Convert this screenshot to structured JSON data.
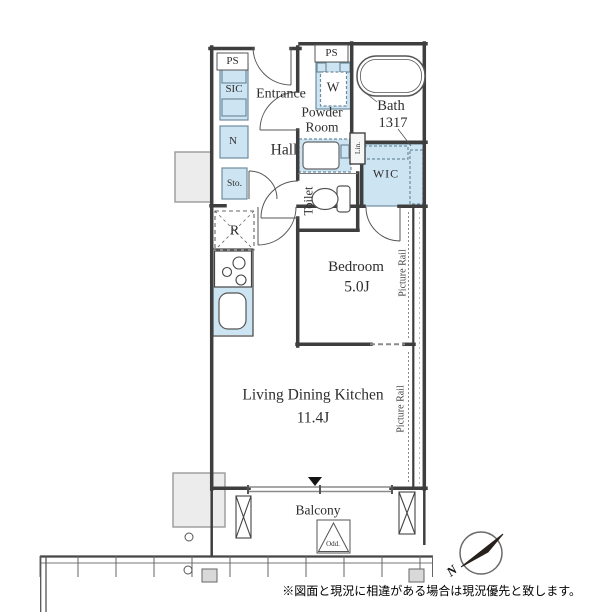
{
  "labels": {
    "ps_left": "PS",
    "ps_right": "PS",
    "sic": "SIC",
    "entrance": "Entrance",
    "washer": "W",
    "powder_line1": "Powder",
    "powder_line2": "Room",
    "bath": "Bath",
    "bath_dim": "1317",
    "closet_n": "N",
    "hall": "Hall",
    "storage": "Sto.",
    "linen": "Lin.",
    "wic": "WIC",
    "toilet": "Toilet",
    "refrigerator": "R",
    "bedroom": "Bedroom",
    "bedroom_size": "5.0J",
    "picture_rail_bedroom": "Picture Rail",
    "ldk": "Living Dining Kitchen",
    "ldk_size": "11.4J",
    "picture_rail_ldk": "Picture Rail",
    "balcony": "Balcony",
    "outdoor_unit": "Odd.",
    "compass_north": "N",
    "disclaimer": "※図面と現況に相違がある場合は現況優先と致します。"
  },
  "colors": {
    "wall": "#3e3e3e",
    "fixture_fill": "#cde4f2",
    "fixture_stroke": "#6e8ca0",
    "common_area_fill": "#ececec",
    "thin_line": "#555555"
  }
}
